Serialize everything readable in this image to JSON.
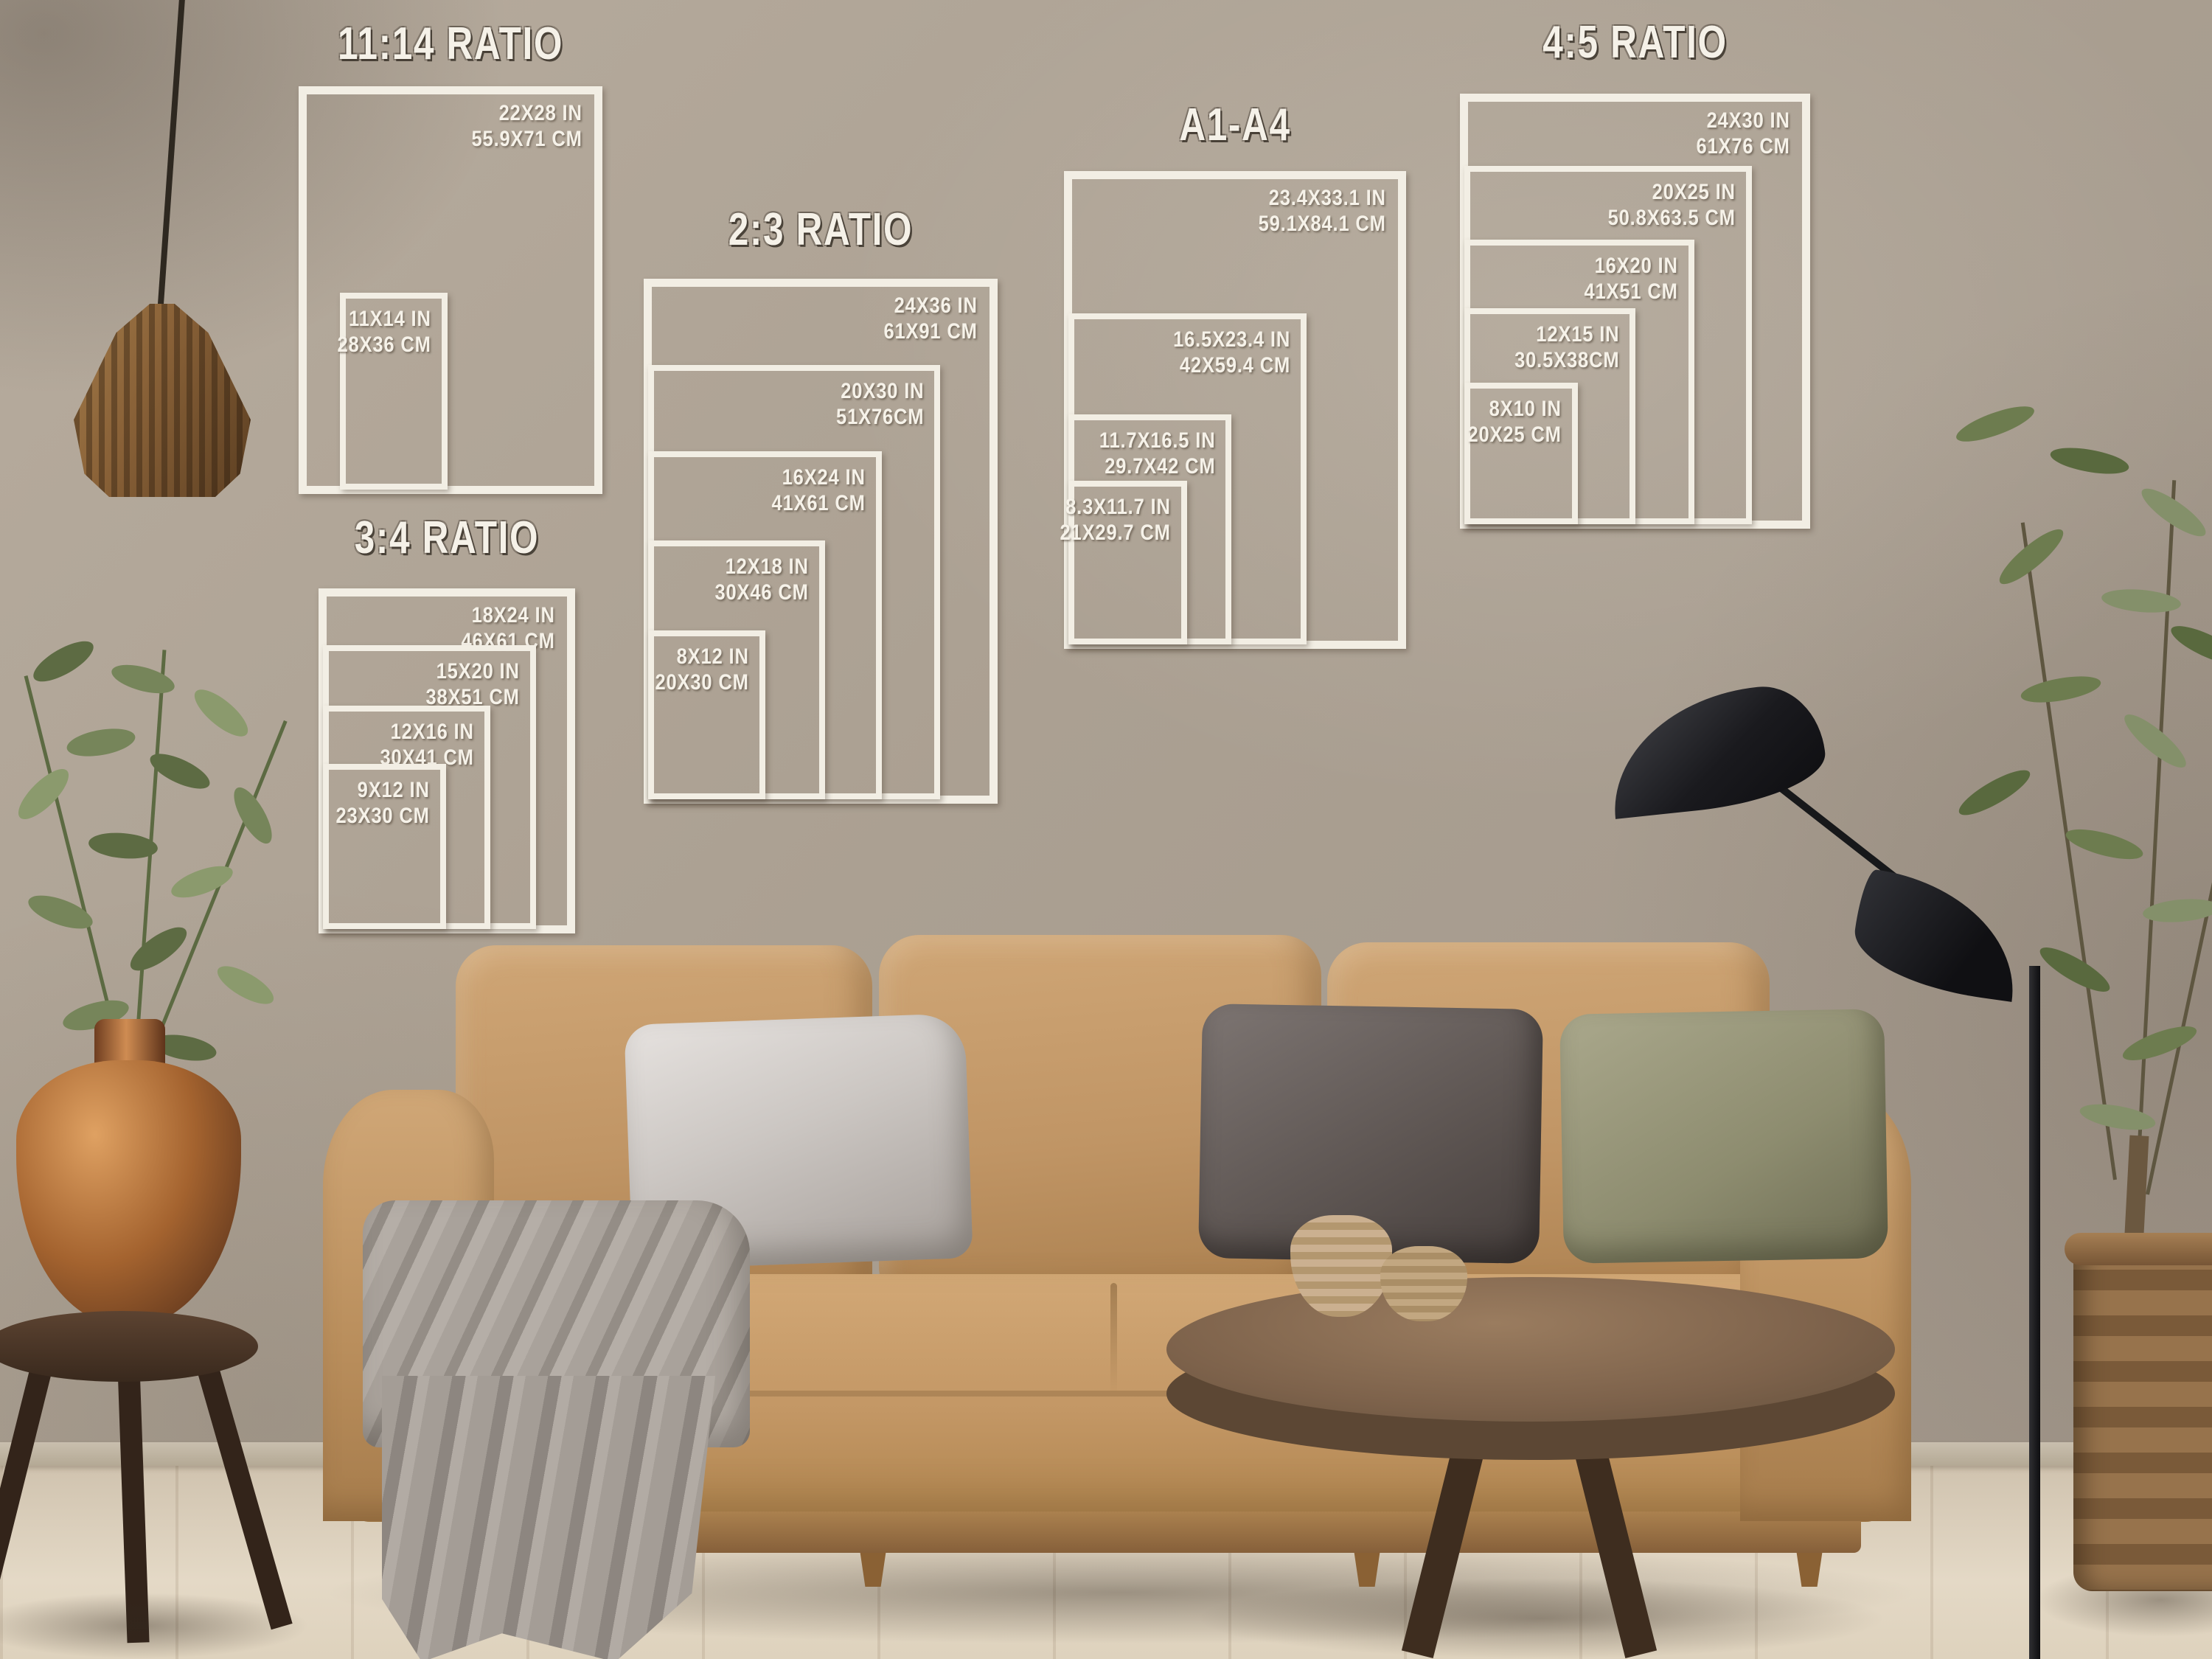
{
  "poster_guide": {
    "groups": [
      {
        "title": "11:14 RATIO",
        "sizes": [
          {
            "in": "22X28 IN",
            "cm": "55.9X71 CM"
          },
          {
            "in": "11X14 IN",
            "cm": "28X36 CM"
          }
        ]
      },
      {
        "title": "3:4 RATIO",
        "sizes": [
          {
            "in": "18X24 IN",
            "cm": "46X61 CM"
          },
          {
            "in": "15X20 IN",
            "cm": "38X51 CM"
          },
          {
            "in": "12X16 IN",
            "cm": "30X41 CM"
          },
          {
            "in": "9X12 IN",
            "cm": "23X30 CM"
          }
        ]
      },
      {
        "title": "2:3 RATIO",
        "sizes": [
          {
            "in": "24X36 IN",
            "cm": "61X91 CM"
          },
          {
            "in": "20X30 IN",
            "cm": "51X76CM"
          },
          {
            "in": "16X24 IN",
            "cm": "41X61 CM"
          },
          {
            "in": "12X18 IN",
            "cm": "30X46 CM"
          },
          {
            "in": "8X12 IN",
            "cm": "20X30 CM"
          }
        ]
      },
      {
        "title": "A1-A4",
        "sizes": [
          {
            "in": "23.4X33.1 IN",
            "cm": "59.1X84.1 CM"
          },
          {
            "in": "16.5X23.4 IN",
            "cm": "42X59.4 CM"
          },
          {
            "in": "11.7X16.5 IN",
            "cm": "29.7X42 CM"
          },
          {
            "in": "8.3X11.7 IN",
            "cm": "21X29.7 CM"
          }
        ]
      },
      {
        "title": "4:5 RATIO",
        "sizes": [
          {
            "in": "24X30 IN",
            "cm": "61X76 CM"
          },
          {
            "in": "20X25 IN",
            "cm": "50.8X63.5 CM"
          },
          {
            "in": "16X20 IN",
            "cm": "41X51 CM"
          },
          {
            "in": "12X15 IN",
            "cm": "30.5X38CM"
          },
          {
            "in": "8X10 IN",
            "cm": "20X25 CM"
          }
        ]
      }
    ]
  },
  "colors": {
    "overlay_white": "#f2eee4",
    "wall": "#ab9f91",
    "floor_wood": "#d9cdbb",
    "sofa_tan": "#c19a6b",
    "pillow_silver": "#cdc8c4",
    "pillow_charcoal": "#5e5652",
    "pillow_olive": "#8f8e72",
    "blanket_gray": "#a29b94",
    "table_wood": "#7c614a",
    "lamp_black": "#1a1a1d",
    "plant_green": "#71804f",
    "vase_copper": "#a4632f"
  }
}
